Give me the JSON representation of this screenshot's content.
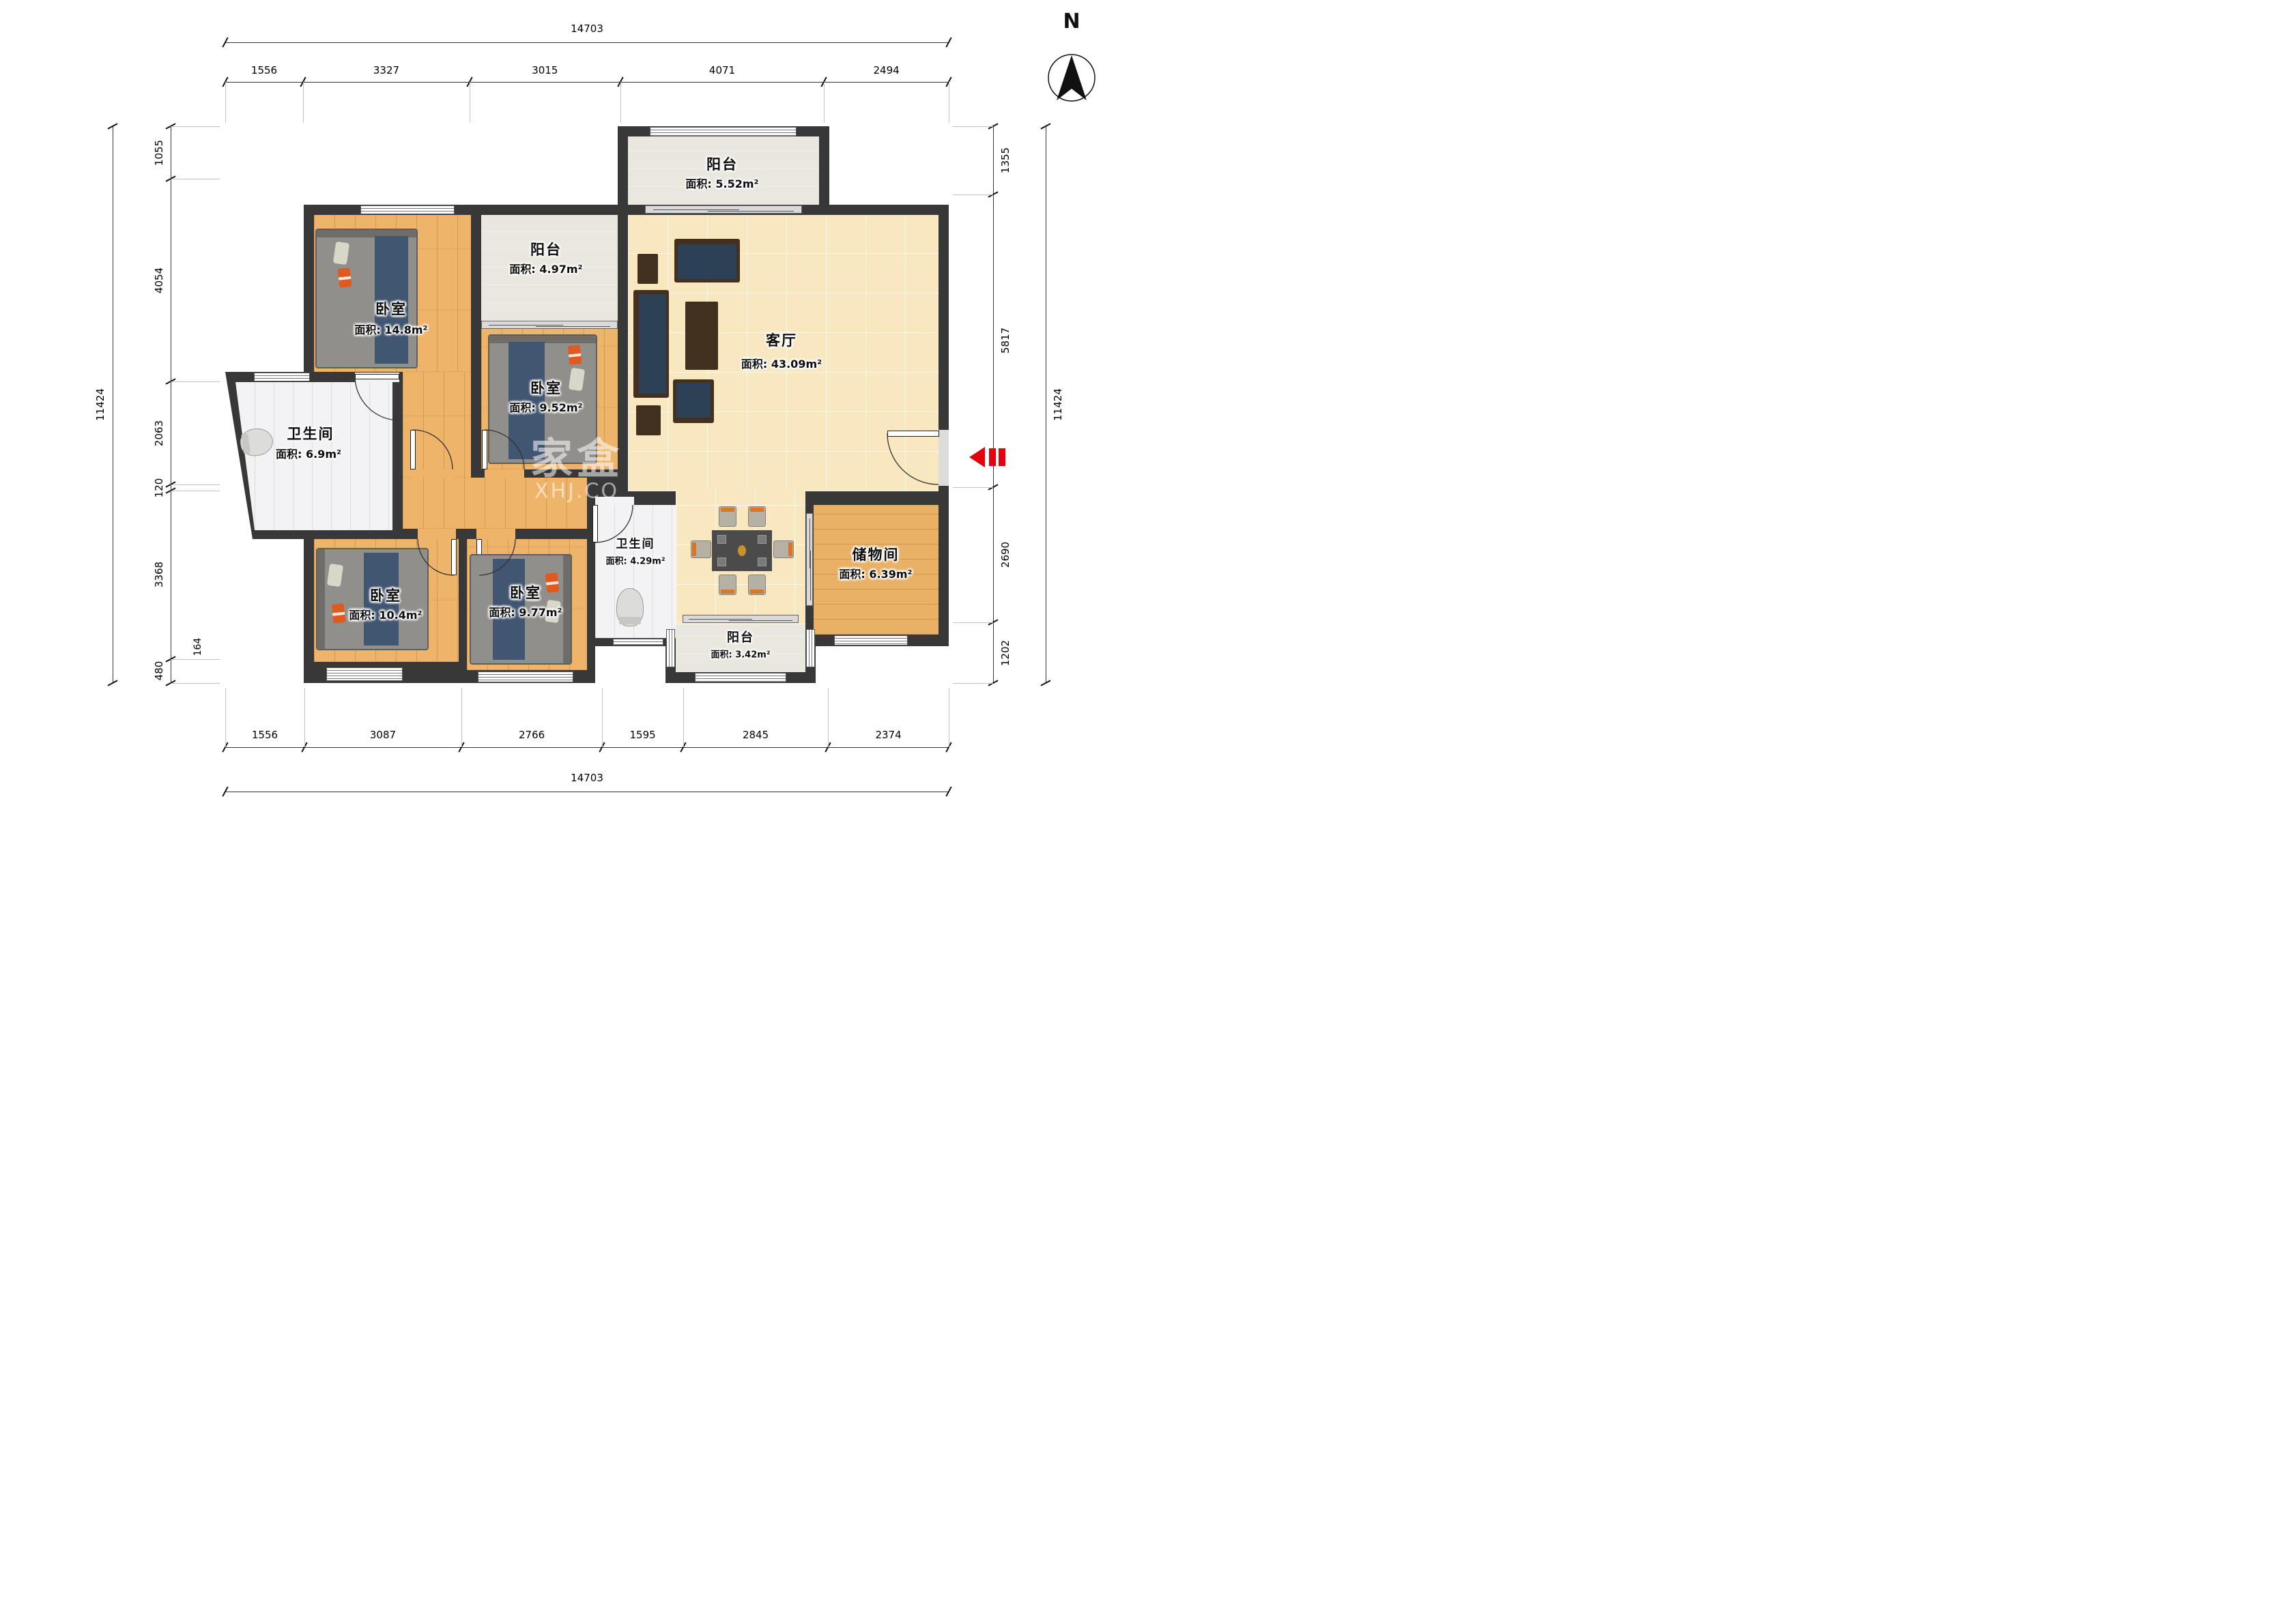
{
  "meta": {
    "compass_label": "N",
    "watermark_line1": "家盒",
    "watermark_line2": "XHJ.CO",
    "entry_arrow_color": "#e3000f",
    "wall_color": "#383838"
  },
  "rooms": {
    "bedroom_top_left": {
      "name": "卧室",
      "area": "面积: 14.8m²"
    },
    "balcony_mid": {
      "name": "阳台",
      "area": "面积: 4.97m²"
    },
    "balcony_top": {
      "name": "阳台",
      "area": "面积: 5.52m²"
    },
    "bedroom_mid": {
      "name": "卧室",
      "area": "面积: 9.52m²"
    },
    "living": {
      "name": "客厅",
      "area": "面积: 43.09m²"
    },
    "bathroom_main": {
      "name": "卫生间",
      "area": "面积: 6.9m²"
    },
    "bedroom_bottom_left": {
      "name": "卧室",
      "area": "面积: 10.4m²"
    },
    "bedroom_bottom_mid": {
      "name": "卧室",
      "area": "面积: 9.77m²"
    },
    "bathroom_small": {
      "name": "卫生间",
      "area": "面积: 4.29m²"
    },
    "storage": {
      "name": "储物间",
      "area": "面积: 6.39m²"
    },
    "balcony_bottom": {
      "name": "阳台",
      "area": "面积: 3.42m²"
    }
  },
  "dimensions": {
    "top": {
      "total": 14703,
      "segments": [
        1556,
        3327,
        3015,
        4071,
        2494
      ]
    },
    "bottom": {
      "total": 14703,
      "segments": [
        1556,
        3087,
        2766,
        1595,
        2845,
        2374
      ]
    },
    "left": {
      "total": 11424,
      "segments": [
        1055,
        4054,
        2063,
        120,
        3368,
        480
      ],
      "inner_segment": 164
    },
    "right": {
      "total": 11424,
      "segments": [
        1355,
        5817,
        2690,
        1202
      ]
    }
  }
}
